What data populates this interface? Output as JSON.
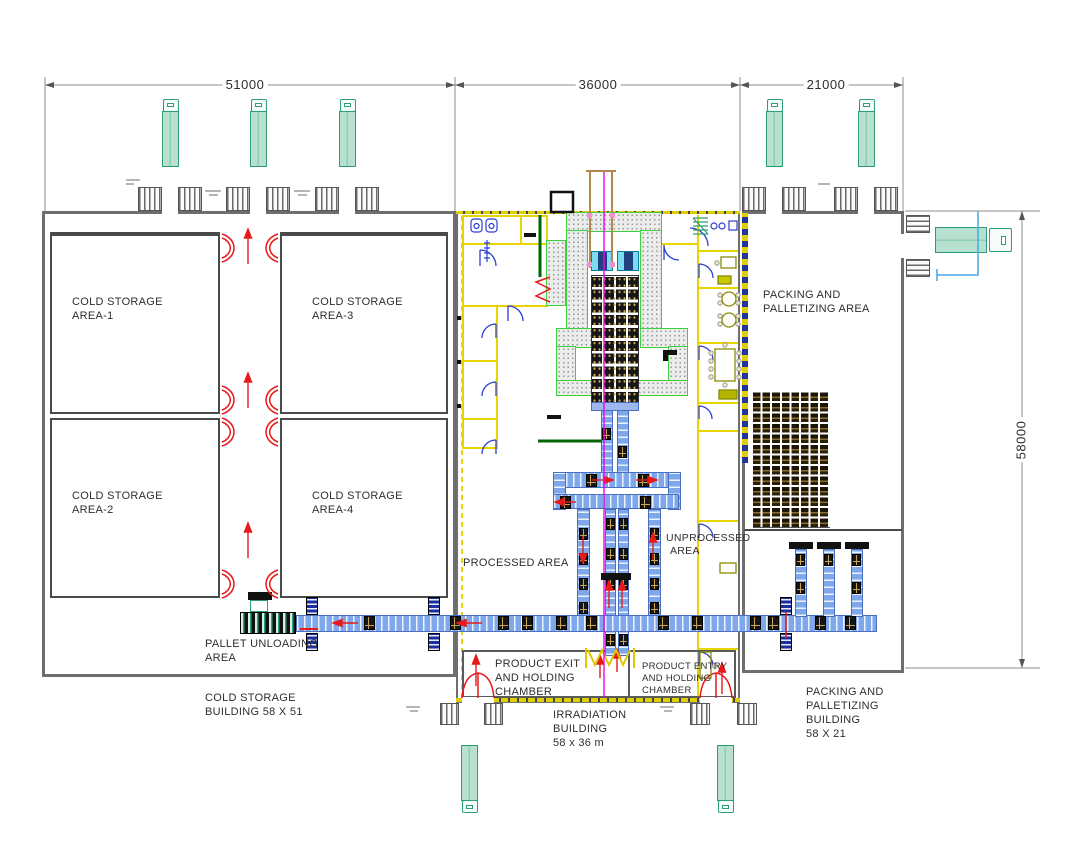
{
  "drawing": {
    "type": "irradiation facility floor plan",
    "dimensions": {
      "top": [
        "51000",
        "36000",
        "21000"
      ],
      "right": [
        "58000"
      ]
    },
    "labels": {
      "cold_area1": [
        "COLD STORAGE",
        "AREA-1"
      ],
      "cold_area3": [
        "COLD STORAGE",
        "AREA-3"
      ],
      "cold_area2": [
        "COLD STORAGE",
        "AREA-2"
      ],
      "cold_area4": [
        "COLD STORAGE",
        "AREA-4"
      ],
      "packing_area": [
        "PACKING AND",
        "PALLETIZING AREA"
      ],
      "processed": [
        "PROCESSED AREA"
      ],
      "unprocessed": [
        "UNPROCESSED",
        "AREA"
      ],
      "pallet_unloading": [
        "PALLET UNLOADING",
        "AREA"
      ],
      "product_exit": [
        "PRODUCT EXIT",
        "AND HOLDING",
        "CHAMBER"
      ],
      "product_entry": [
        "PRODUCT ENTRY",
        "AND HOLDING",
        "CHAMBER"
      ],
      "cold_building": [
        "COLD STORAGE",
        "BUILDING 58 X 51"
      ],
      "irradiation_building": [
        "IRRADIATION",
        "BUILDING",
        "58 x 36 m"
      ],
      "packing_building": [
        "PACKING AND",
        "PALLETIZING",
        "BUILDING",
        "58 X 21"
      ]
    },
    "colors": {
      "truck_fill": "#b7e0cf",
      "truck_stroke": "#2f9e78",
      "wall_gray": "#6e6e6e",
      "room_wall": "#4a4a4a",
      "wall_yellow": "#e8d400",
      "conveyor_blue": "#7fa8ea",
      "shuttle_navy": "#1b2fa0",
      "door_red": "#e81919",
      "door_blue": "#2b3fd0",
      "maze_edge": "#3ecf3e",
      "maze_fill": "#ececec",
      "wall_green": "#006400",
      "source_line_magenta": "#f000f0",
      "crane_rail_tan": "#b08850",
      "pallet_brown": "#2a2008",
      "dim_gray": "#8c8c8c",
      "text": "#2e2e2e",
      "truck_path_blue": "#49a7e8"
    }
  }
}
